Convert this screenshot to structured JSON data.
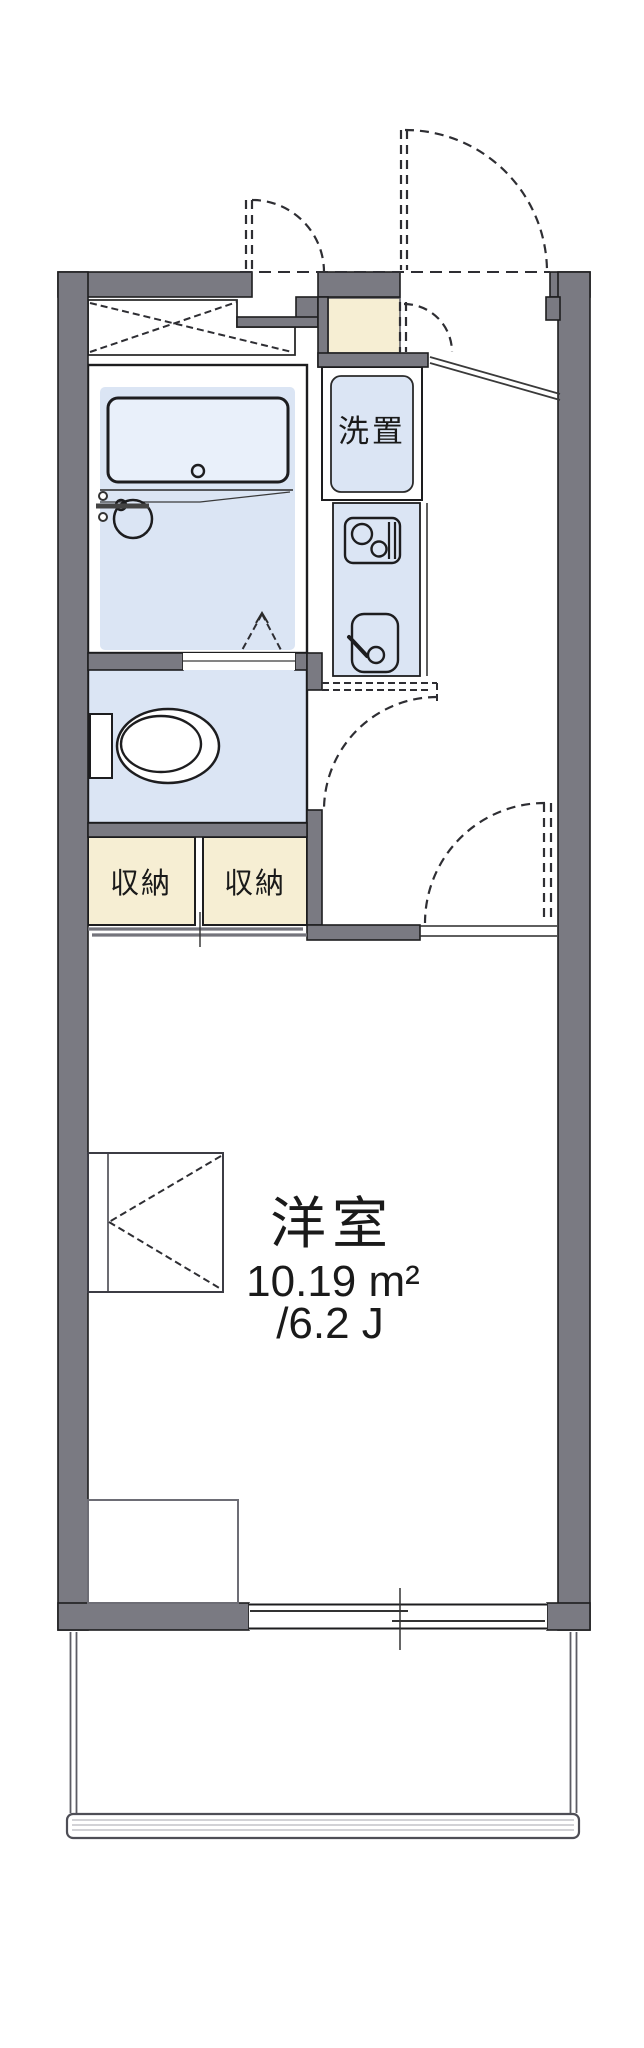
{
  "floor_plan": {
    "labels": {
      "washer": "洗置",
      "storage_left": "収納",
      "storage_right": "収納"
    },
    "main_room": {
      "name": "洋室",
      "area": "10.19 m²",
      "tatami_size": "/6.2 J"
    },
    "colors": {
      "wall": "#7a7a82",
      "room_blue": "#dbe5f4",
      "tub_blue": "#e9f0fa",
      "cream": "#f6eed3",
      "line_dark": "#1d1d1f",
      "line_gray": "#70707a"
    }
  }
}
